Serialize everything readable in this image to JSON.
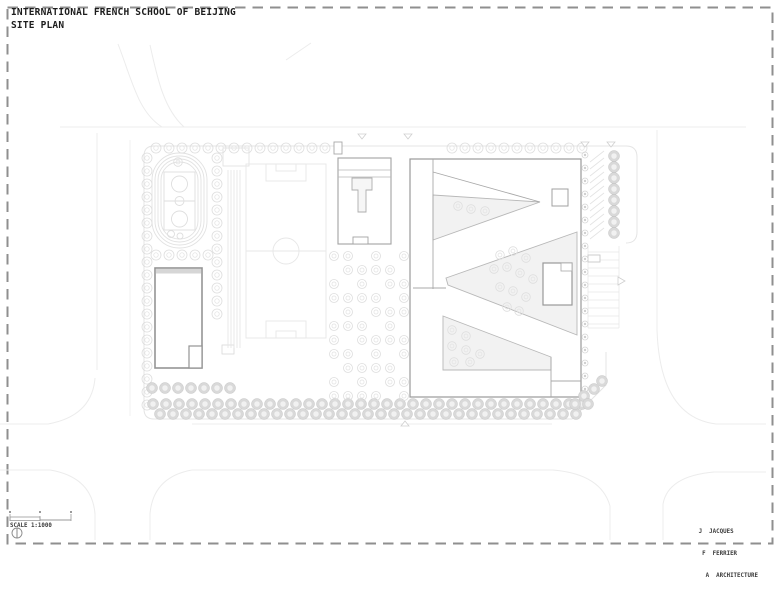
{
  "sheet": {
    "title": "INTERNATIONAL FRENCH SCHOOL OF BEIJING",
    "subtitle": "SITE PLAN",
    "scale": {
      "label": "SCALE 1:1000"
    },
    "credits": {
      "line1": "J  JACQUES",
      "line2": " F  FERRIER",
      "line3": "  A  ARCHITECTURE"
    },
    "colors": {
      "building_line": "#9a9a9a",
      "landscape_line": "#e6e6e6",
      "courtyard_fill": "#f2f2f2",
      "border_dash": "#8f8f8f",
      "text": "#1c1c1c"
    }
  }
}
